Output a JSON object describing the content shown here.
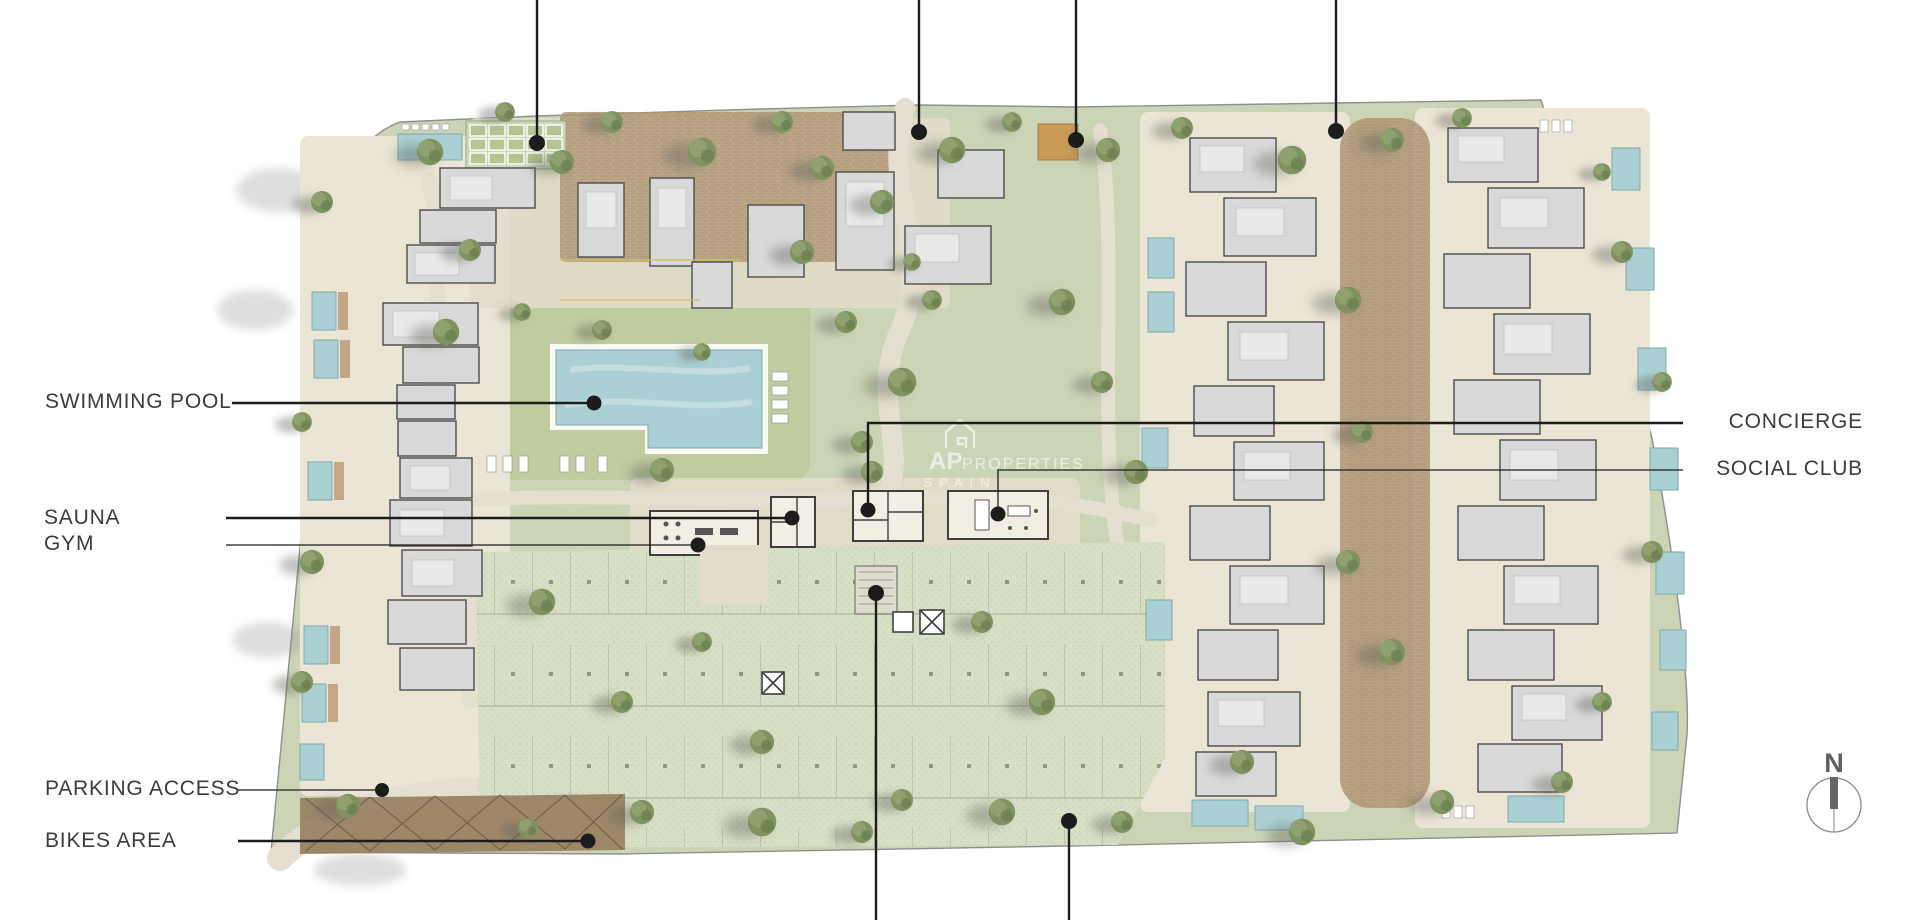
{
  "plan": {
    "callouts": {
      "swimming_pool": "SWIMMING POOL",
      "sauna": "SAUNA",
      "gym": "GYM",
      "parking_access": "PARKING ACCESS",
      "bikes_area": "BIKES AREA",
      "concierge": "CONCIERGE",
      "social_club": "SOCIAL CLUB"
    },
    "compass": {
      "north_label": "N"
    },
    "watermark": {
      "brand_primary": "AP",
      "brand_secondary": "PROPERTIES",
      "brand_tagline": "SPAIN"
    },
    "colors": {
      "label_text": "#3c3c3c",
      "leader_line": "#1c1c1c",
      "site_green": "#ccd4b6",
      "parking_green": "#d7dfc4",
      "lawn_green": "#c0cc9f",
      "path_beige": "#e4dfd0",
      "mulch_brown": "#b29878",
      "deck_brown": "#c5a787",
      "roof_gray": "#d9d9d9",
      "pool_teal": "#abd0d4",
      "tree_green": "#7f9260",
      "watermark_white": "#ffffff",
      "compass_gray": "#5f5f5f"
    }
  }
}
